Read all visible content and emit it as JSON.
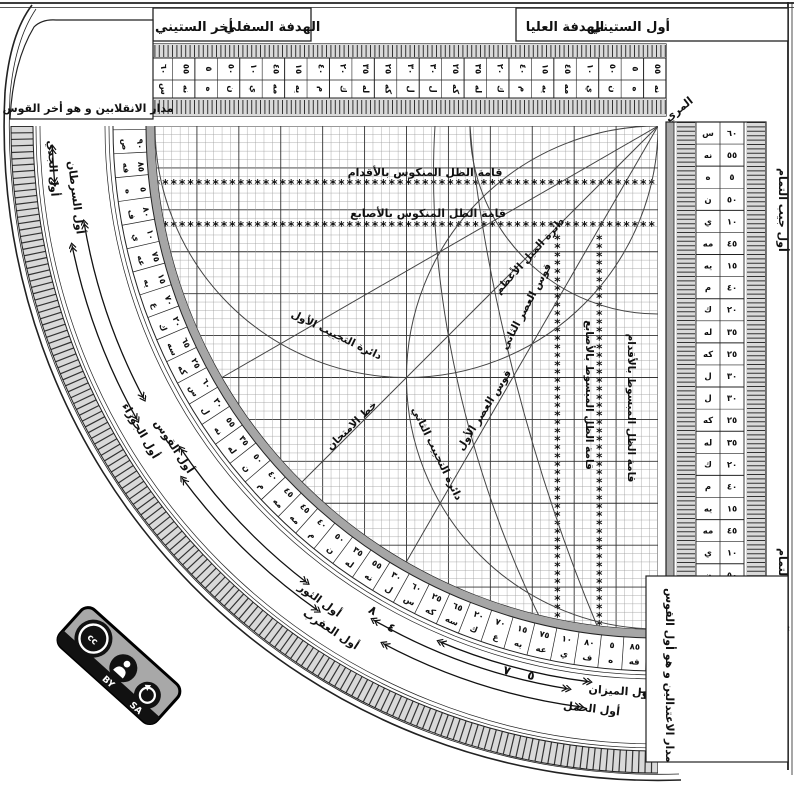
{
  "header": {
    "lower_sight": "الهدفة السفلي",
    "sixty_end": "أخر الستيني",
    "upper_sight": "الهدفة العليا",
    "sixty_start": "أول الستيني",
    "muri": "المري",
    "solstice_panel": "مدار الانقلابين و هو أخر القوس",
    "equinox_panel": "مدار الاعتدالين و هو أول القوس",
    "cosine_start": "أول جيب التمام",
    "cosine_end": "آخر جيب التمام"
  },
  "grid_labels": {
    "feet_reversed": "قامة الظل المنكوس بالأقدام",
    "digits_reversed": "قامة الظل المنكوس بالأصابع",
    "digits_extended": "قامة الظل المبسوط بالأصابع",
    "feet_extended": "قامة الظل المبسوط بالأقدام",
    "max_declination": "دائرة الميل الأعظم",
    "asr_second": "قوس العصر الثاني",
    "asr_first": "قوس العصر الأول",
    "test_line": "خط الامتحان",
    "sine_circle_first": "دائرة التجييب الأول",
    "sine_circle_second": "دائرة التجييب الثاني"
  },
  "sixty_scale_cells": [
    {
      "l": "س",
      "v": "٦٠"
    },
    {
      "l": "نه",
      "v": "٥٥"
    },
    {
      "l": "ه",
      "v": "٥"
    },
    {
      "l": "ن",
      "v": "٥٠"
    },
    {
      "l": "ي",
      "v": "١٠"
    },
    {
      "l": "مه",
      "v": "٤٥"
    },
    {
      "l": "يه",
      "v": "١٥"
    },
    {
      "l": "م",
      "v": "٤٠"
    },
    {
      "l": "ك",
      "v": "٢٠"
    },
    {
      "l": "له",
      "v": "٣٥"
    },
    {
      "l": "كه",
      "v": "٢٥"
    },
    {
      "l": "ل",
      "v": "٣٠"
    },
    {
      "l": "ل",
      "v": "٣٠"
    },
    {
      "l": "كه",
      "v": "٢٥"
    },
    {
      "l": "له",
      "v": "٣٥"
    },
    {
      "l": "ك",
      "v": "٢٠"
    },
    {
      "l": "م",
      "v": "٤٠"
    },
    {
      "l": "يه",
      "v": "١٥"
    },
    {
      "l": "مه",
      "v": "٤٥"
    },
    {
      "l": "ي",
      "v": "١٠"
    },
    {
      "l": "ن",
      "v": "٥٠"
    },
    {
      "l": "ه",
      "v": "٥"
    },
    {
      "l": "نه",
      "v": "٥٥"
    }
  ],
  "degree_scale_cells": [
    {
      "l": "ص",
      "v": "٩٠"
    },
    {
      "l": "فه",
      "v": "٨٥"
    },
    {
      "l": "ه",
      "v": "٥"
    },
    {
      "l": "ف",
      "v": "٨٠"
    },
    {
      "l": "ي",
      "v": "١٠"
    },
    {
      "l": "عه",
      "v": "٧٥"
    },
    {
      "l": "يه",
      "v": "١٥"
    },
    {
      "l": "ع",
      "v": "٧٠"
    },
    {
      "l": "ك",
      "v": "٢٠"
    },
    {
      "l": "سه",
      "v": "٦٥"
    },
    {
      "l": "كه",
      "v": "٢٥"
    },
    {
      "l": "س",
      "v": "٦٠"
    },
    {
      "l": "ل",
      "v": "٣٠"
    },
    {
      "l": "نه",
      "v": "٥٥"
    },
    {
      "l": "له",
      "v": "٣٥"
    },
    {
      "l": "ن",
      "v": "٥٠"
    },
    {
      "l": "م",
      "v": "٤٠"
    },
    {
      "l": "مه",
      "v": "٤٥"
    },
    {
      "l": "مه",
      "v": "٤٥"
    },
    {
      "l": "م",
      "v": "٤٠"
    },
    {
      "l": "ن",
      "v": "٥٠"
    },
    {
      "l": "له",
      "v": "٣٥"
    },
    {
      "l": "نه",
      "v": "٥٥"
    },
    {
      "l": "ل",
      "v": "٣٠"
    },
    {
      "l": "س",
      "v": "٦٠"
    },
    {
      "l": "كه",
      "v": "٢٥"
    },
    {
      "l": "سه",
      "v": "٦٥"
    },
    {
      "l": "ك",
      "v": "٢٠"
    },
    {
      "l": "ع",
      "v": "٧٠"
    },
    {
      "l": "يه",
      "v": "١٥"
    },
    {
      "l": "عه",
      "v": "٧٥"
    },
    {
      "l": "ي",
      "v": "١٠"
    },
    {
      "l": "ف",
      "v": "٨٠"
    },
    {
      "l": "ه",
      "v": "٥"
    },
    {
      "l": "فه",
      "v": "٨٥"
    }
  ],
  "zodiac_labels": [
    {
      "text": "أول الجدي",
      "angle": 176,
      "radius": 610
    },
    {
      "text": "أول السرطان",
      "angle": 173,
      "radius": 590
    },
    {
      "text": "أول الجوزاء",
      "angle": 149.5,
      "radius": 604
    },
    {
      "text": "أول القوس",
      "angle": 146.5,
      "radius": 584
    },
    {
      "text": "أول العقرب",
      "angle": 123,
      "radius": 604
    },
    {
      "text": "أول الثور",
      "angle": 125.5,
      "radius": 586
    },
    {
      "text": "أول الحمل",
      "angle": 96.5,
      "radius": 590
    },
    {
      "text": "أول الميزان",
      "angle": 93.8,
      "radius": 570
    }
  ],
  "arc_numbers": [
    {
      "v": "٨",
      "angle": 120.5,
      "radius": 566
    },
    {
      "v": "٤",
      "angle": 118,
      "radius": 572
    },
    {
      "v": "٧",
      "angle": 105.5,
      "radius": 569
    },
    {
      "v": "٥",
      "angle": 103,
      "radius": 568
    },
    {
      "v": "٦",
      "angle": 91.5,
      "radius": 573
    }
  ],
  "arrows": [
    {
      "r": 582,
      "a1": 170.5,
      "a2": 152
    },
    {
      "r": 598,
      "a1": 168.5,
      "a2": 150.5
    },
    {
      "r": 576,
      "a1": 146,
      "a2": 127.5
    },
    {
      "r": 592,
      "a1": 143.5,
      "a2": 125
    },
    {
      "r": 570,
      "a1": 120,
      "a2": 99
    },
    {
      "r": 586,
      "a1": 118,
      "a2": 97.5
    },
    {
      "r": 606,
      "a1": 178,
      "a2": 174.5
    },
    {
      "r": 560,
      "a1": 113,
      "a2": 97
    }
  ],
  "badge": {
    "cc": "cc",
    "by": "BY",
    "sa": "SA"
  },
  "colors": {
    "ink": "#111111",
    "gray_band": "#a6a6a6",
    "tick_bg": "#d9d9d9",
    "badge_gray": "#a8a8a8"
  }
}
